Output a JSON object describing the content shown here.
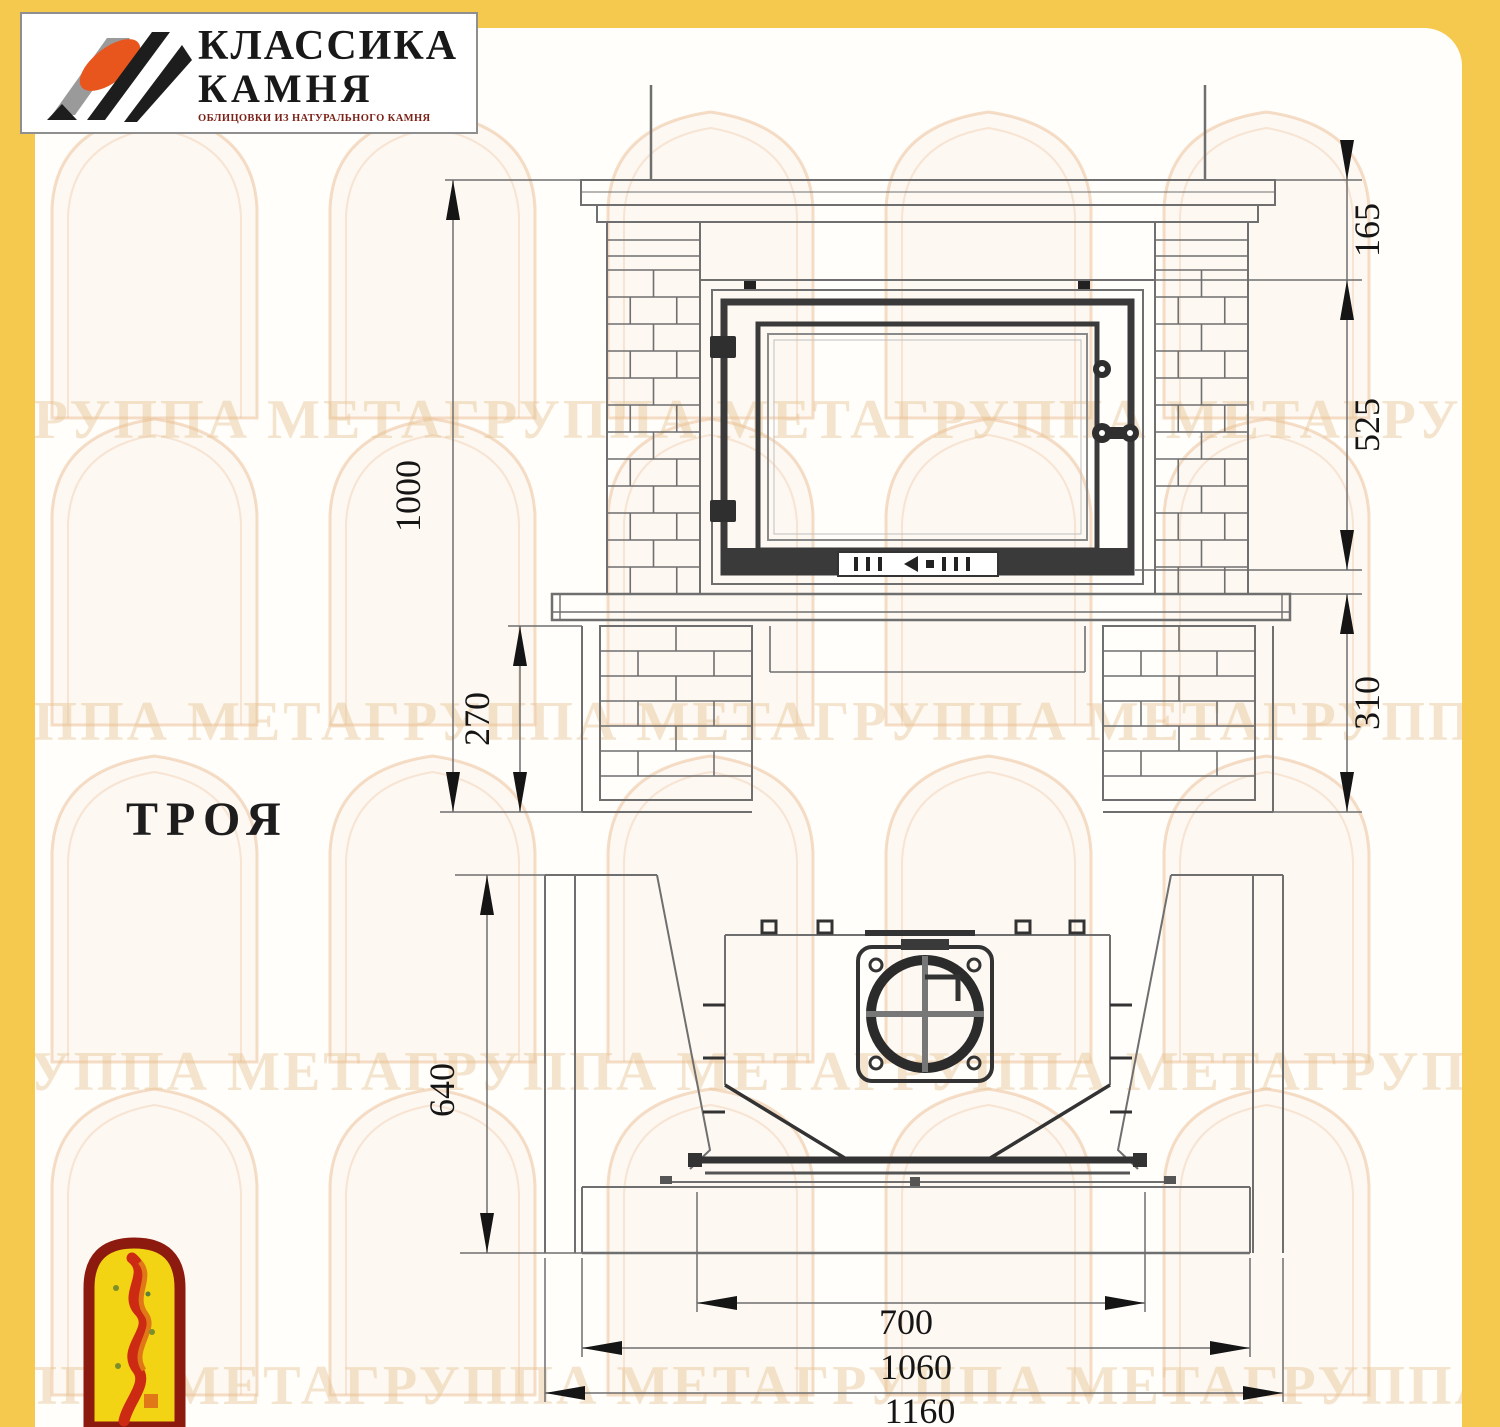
{
  "brand": {
    "title_line1": "КЛАССИКА",
    "title_line2": "КАМНЯ",
    "subtitle": "ОБЛИЦОВКИ ИЗ НАТУРАЛЬНОГО КАМНЯ"
  },
  "model_label": "ТРОЯ",
  "watermark_text": "ГРУППА МЕТАГРУППА МЕТАГРУППА МЕТАГРУППА МЕТА",
  "front_view": {
    "dims": {
      "total_height": "1000",
      "mantel_zone": "165",
      "firebox_zone": "525",
      "base_zone": "310",
      "plinth_height": "270"
    }
  },
  "top_view": {
    "dims": {
      "depth": "640",
      "firebox_width": "700",
      "hearth_width": "1060",
      "total_width": "1160"
    }
  },
  "colors": {
    "frame_yellow": "#f5c84e",
    "line_gray": "#6f6f6f",
    "line_dark": "#3a3a3a",
    "emblem_red": "#8d1a0e",
    "emblem_yellow": "#f2d414",
    "logo_orange": "#e8561e"
  }
}
